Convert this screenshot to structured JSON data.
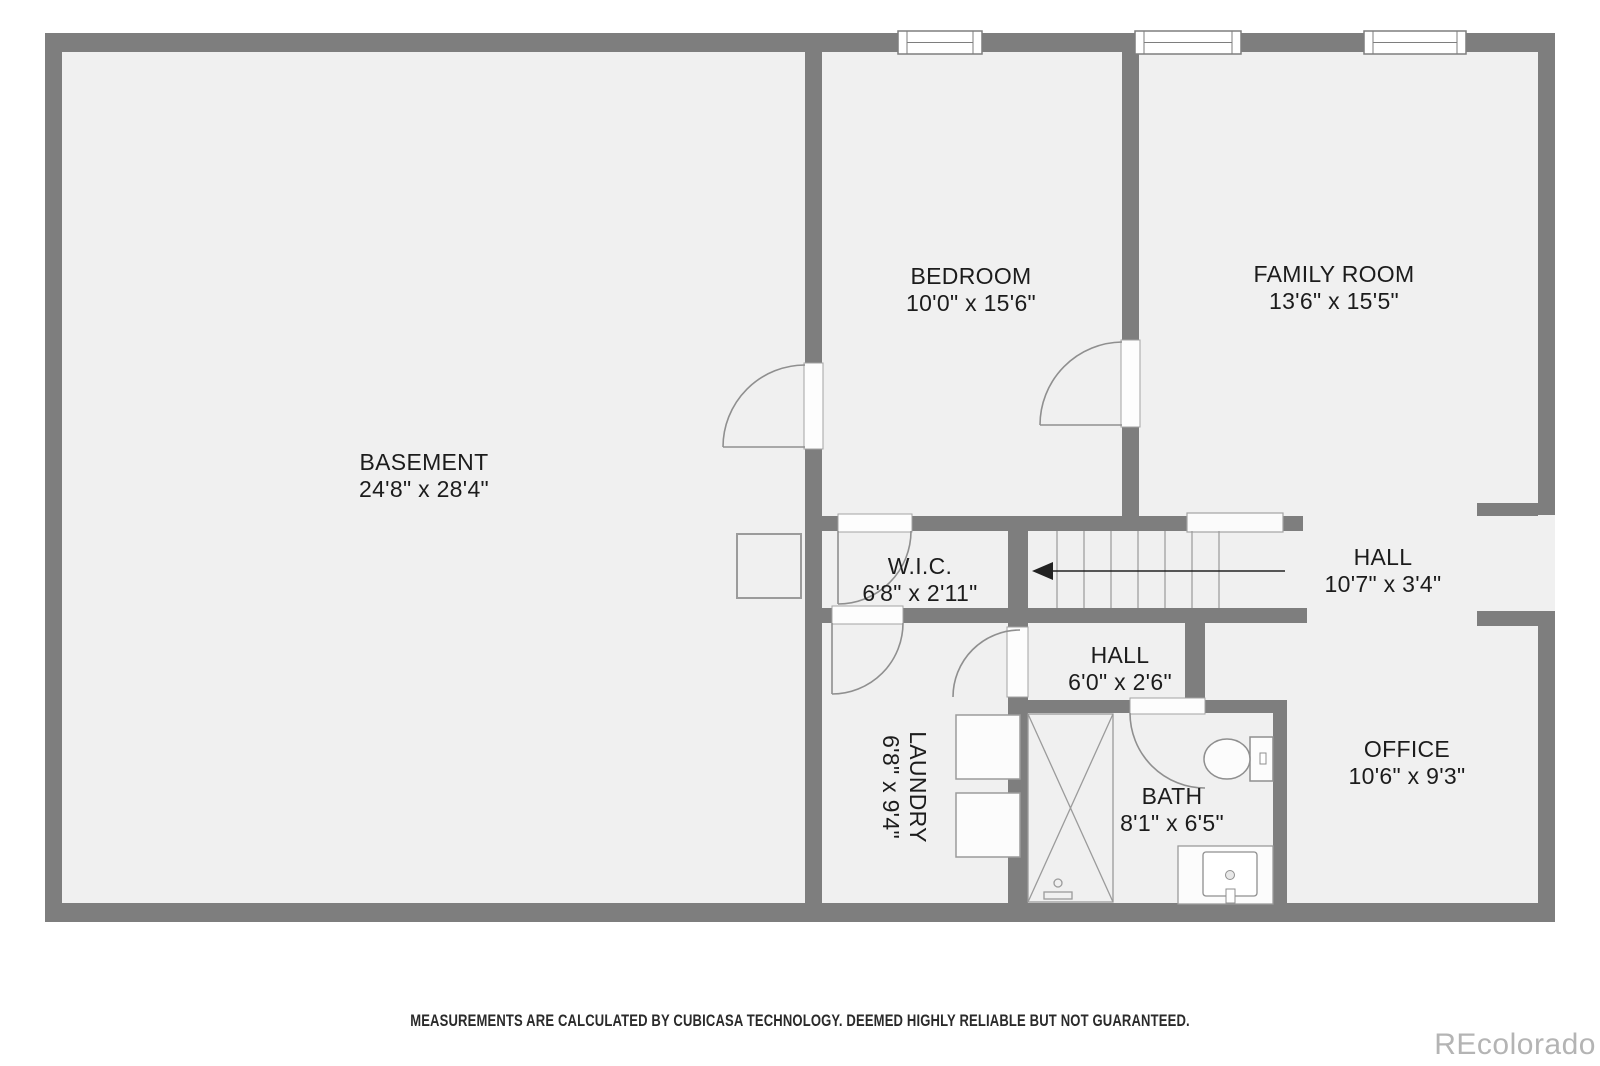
{
  "colors": {
    "wall": "#7e7e7e",
    "floor": "#f0f0f0",
    "fixture_line": "#8f8f8f",
    "text": "#1c1c1c",
    "watermark": "#b4b4b4"
  },
  "plan": {
    "rooms": [
      {
        "id": "basement",
        "name": "BASEMENT",
        "dims": "24'8\" x 28'4\""
      },
      {
        "id": "bedroom",
        "name": "BEDROOM",
        "dims": "10'0\" x 15'6\""
      },
      {
        "id": "family-room",
        "name": "FAMILY ROOM",
        "dims": "13'6\" x 15'5\""
      },
      {
        "id": "wic",
        "name": "W.I.C.",
        "dims": "6'8\" x 2'11\""
      },
      {
        "id": "hall-upper",
        "name": "HALL",
        "dims": "10'7\" x 3'4\""
      },
      {
        "id": "hall-lower",
        "name": "HALL",
        "dims": "6'0\" x 2'6\""
      },
      {
        "id": "laundry",
        "name": "LAUNDRY",
        "dims": "6'8\" x 9'4\""
      },
      {
        "id": "bath",
        "name": "BATH",
        "dims": "8'1\" x 6'5\""
      },
      {
        "id": "office",
        "name": "OFFICE",
        "dims": "10'6\" x 9'3\""
      }
    ]
  },
  "footer": {
    "disclaimer": "MEASUREMENTS ARE CALCULATED BY CUBICASA TECHNOLOGY. DEEMED HIGHLY RELIABLE BUT NOT GUARANTEED."
  },
  "watermark": "REcolorado"
}
